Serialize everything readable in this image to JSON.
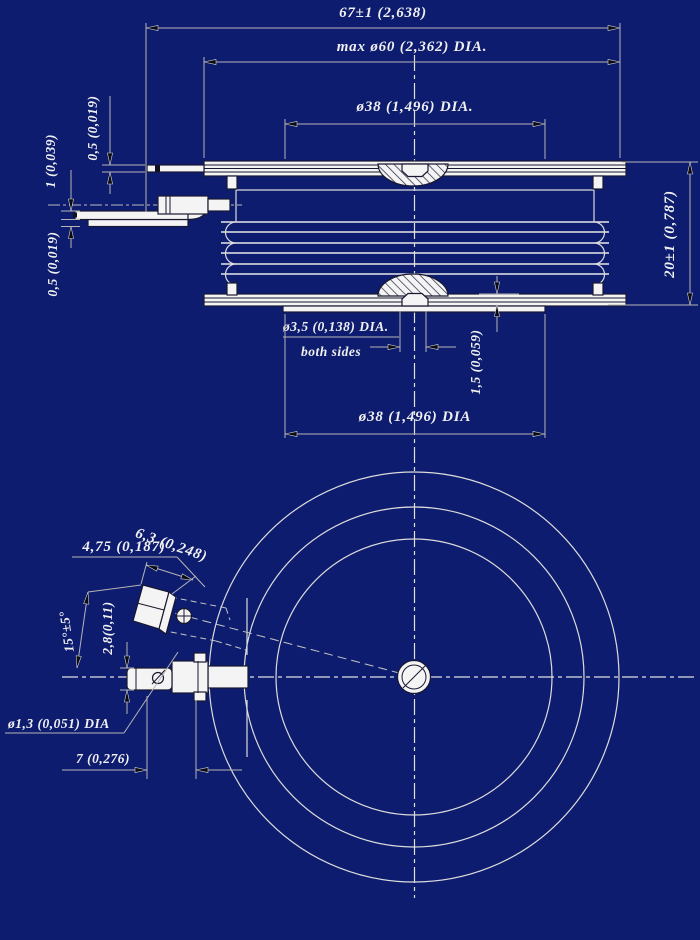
{
  "title": "Disc device outline drawing",
  "colors": {
    "background": "#0d1c6e",
    "linework_light": "#dcdcdc",
    "linework_dark": "#181830",
    "dimension_lines": "#b5b5b5",
    "text": "#f0f0f0",
    "shape_fill": "#f4f4f4",
    "arrowhead": "#0b0b16"
  },
  "side_view": {
    "dim_overall_width": "67±1 (2,638)",
    "dim_max_diameter": "max ø60 (2,362) DIA.",
    "dim_pole_diameter_top": "ø38 (1,496) DIA.",
    "dim_lead_thickness_top": "0,5 (0,019)",
    "dim_terminal_thickness": "1 (0,039)",
    "dim_lead_thickness_bottom": "0,5 (0,019)",
    "dim_height": "20±1 (0,787)",
    "dim_gate_hole": "ø3,5 (0,138) DIA.",
    "note_gate_hole": "both sides",
    "dim_recess_depth": "1,5 (0,059)",
    "dim_pole_diameter_bottom": "ø38 (1,496) DIA"
  },
  "plan_view": {
    "dim_tab_length": "6,3 (0,248)",
    "dim_tab_width": "4,75 (0,187)",
    "dim_lead_angle": "15°±5°",
    "dim_tab_thickness": "2,8(0,11)",
    "dim_hole_diameter": "ø1,3 (0,051) DIA",
    "dim_terminal_offset": "7 (0,276)"
  }
}
